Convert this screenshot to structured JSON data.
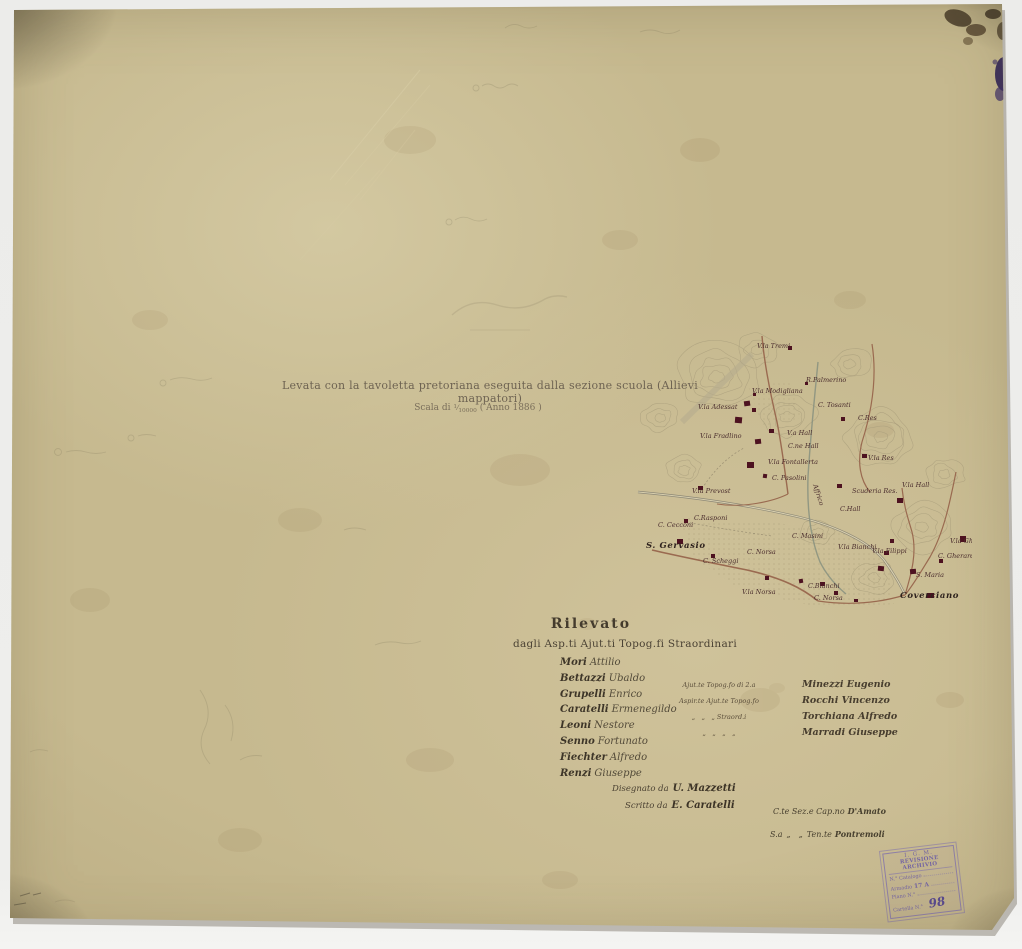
{
  "colors": {
    "paper": "#c6b98f",
    "ink": "#4b4234",
    "map_ink": "#4b2e2e",
    "stamp_violet": "#7a6cae",
    "building_red": "#4d1220"
  },
  "document": {
    "title": "Levata con la tavoletta pretoriana eseguita dalla sezione scuola (Allievi mappatori)",
    "scale_prefix": "Scala di",
    "scale_numerator": "1",
    "scale_denominator": "10000",
    "scale_suffix": "( Anno 1886 )"
  },
  "map": {
    "labels": [
      {
        "text": "V.la Tremi",
        "x": 135,
        "y": 26
      },
      {
        "text": "R.Palmerino",
        "x": 184,
        "y": 60
      },
      {
        "text": "V.la Modigliana",
        "x": 130,
        "y": 71
      },
      {
        "text": "C. Tosanti",
        "x": 196,
        "y": 85
      },
      {
        "text": "V.la Adessat",
        "x": 76,
        "y": 87
      },
      {
        "text": "C.Res",
        "x": 236,
        "y": 98
      },
      {
        "text": "V.a Hall",
        "x": 165,
        "y": 113
      },
      {
        "text": "C.ne Hall",
        "x": 166,
        "y": 126
      },
      {
        "text": "V.la Fradlino",
        "x": 78,
        "y": 116
      },
      {
        "text": "V.la Res",
        "x": 246,
        "y": 138
      },
      {
        "text": "V.la Fontallerta",
        "x": 146,
        "y": 142
      },
      {
        "text": "C. Pasolini",
        "x": 150,
        "y": 158
      },
      {
        "text": "Affrico",
        "x": 191,
        "y": 163,
        "angle": 72
      },
      {
        "text": "V.la Prevost",
        "x": 70,
        "y": 171
      },
      {
        "text": "Scuderia Res.",
        "x": 230,
        "y": 171
      },
      {
        "text": "V.la Hall",
        "x": 280,
        "y": 165
      },
      {
        "text": "C.Hall",
        "x": 218,
        "y": 189
      },
      {
        "text": "C.Rasponi",
        "x": 72,
        "y": 198
      },
      {
        "text": "C. Cecconi",
        "x": 36,
        "y": 205
      },
      {
        "text": "S. Gervasio",
        "x": 24,
        "y": 226,
        "bold": true
      },
      {
        "text": "C. Masini",
        "x": 170,
        "y": 216
      },
      {
        "text": "V.la Bianchi",
        "x": 216,
        "y": 227
      },
      {
        "text": "V.la Filippi",
        "x": 250,
        "y": 231
      },
      {
        "text": "C. Norsa",
        "x": 125,
        "y": 232
      },
      {
        "text": "C. Scheggi",
        "x": 81,
        "y": 241
      },
      {
        "text": "V.la Gherardo",
        "x": 328,
        "y": 221
      },
      {
        "text": "C. Gherardo",
        "x": 316,
        "y": 236
      },
      {
        "text": "S. Maria",
        "x": 294,
        "y": 255
      },
      {
        "text": "V.la Norsa",
        "x": 120,
        "y": 272
      },
      {
        "text": "C.Bianchi",
        "x": 186,
        "y": 266
      },
      {
        "text": "C. Norsa",
        "x": 192,
        "y": 278
      },
      {
        "text": "Coverciano",
        "x": 278,
        "y": 276,
        "bold": true
      }
    ]
  },
  "rilevato": {
    "heading": "Rilevato",
    "subheading": "dagli Asp.ti Ajut.ti Topog.fi Straordinari",
    "surveyors": [
      {
        "surname": "Mori",
        "given": "Attilio"
      },
      {
        "surname": "Bettazzi",
        "given": "Ubaldo"
      },
      {
        "surname": "Grupelli",
        "given": "Enrico"
      },
      {
        "surname": "Caratelli",
        "given": "Ermenegildo"
      },
      {
        "surname": "Leoni",
        "given": "Nestore"
      },
      {
        "surname": "Senno",
        "given": "Fortunato"
      },
      {
        "surname": "Fiechter",
        "given": "Alfredo"
      },
      {
        "surname": "Renzi",
        "given": "Giuseppe"
      }
    ],
    "assistants": [
      {
        "role": "Ajut.te Topog.fo di 2.a",
        "name": "Minezzi Eugenio"
      },
      {
        "role": "Aspir.te Ajut.te Topog.fo",
        "name": "Rocchi Vincenzo"
      },
      {
        "role": "„ „ „ Straord.i",
        "name": "Torchiana Alfredo"
      },
      {
        "role": "„ „ „ „",
        "name": "Marradi Giuseppe"
      }
    ]
  },
  "credits": {
    "lines": [
      {
        "prefix": "Disegnato da",
        "name": "U. Mazzetti"
      },
      {
        "prefix": "Scritto da",
        "name": "E. Caratelli"
      }
    ]
  },
  "officers": {
    "line1_rank": "C.te Sez.e Cap.no",
    "line1_name": "D'Amato",
    "line2_rank": "S.a „  „ Ten.te",
    "line2_name": "Pontremoli"
  },
  "stamp": {
    "header1": "I. G. M.",
    "header2": "REVISIONE ARCHIVIO",
    "row1": "N.° Catalogo",
    "row2_label": "Armadio",
    "row2_value": "17 A",
    "row3": "Piano  N.°",
    "row4_label": "Cartella N.°",
    "row4_value": "98"
  }
}
